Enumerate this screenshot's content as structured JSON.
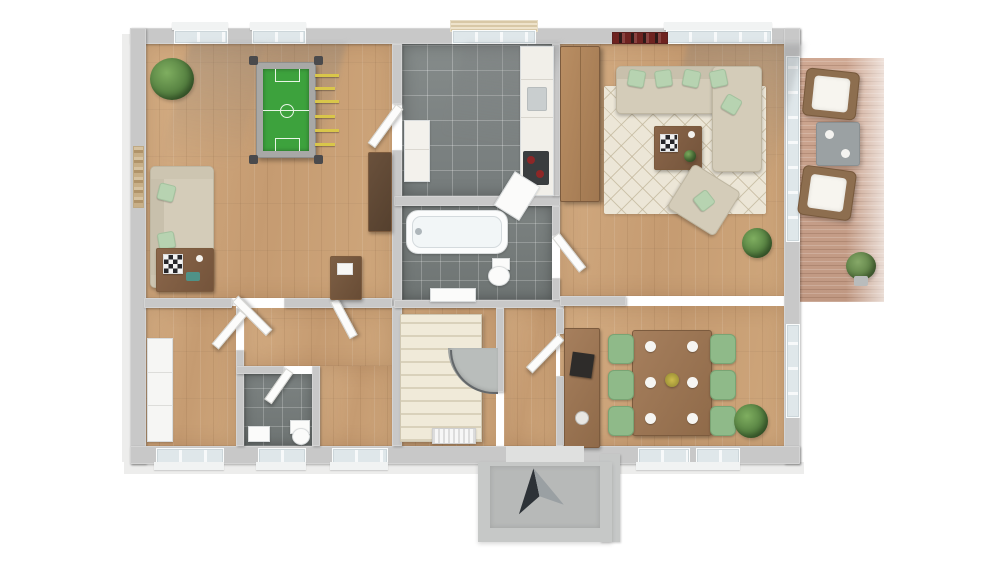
{
  "scene": {
    "type": "3d-floor-plan-render",
    "view": "top-down perspective of a single storey",
    "background": "#ffffff"
  },
  "palette": {
    "wall_cut": "#c8c8c8",
    "wall_face": "#f4f4f4",
    "hardwood": "#cba67c",
    "grey_tile": "#808686",
    "deck_wood": "#c8a18c",
    "rug": "#ece6d7",
    "sofa_beige": "#d4ccb9",
    "pillow_mint": "#b7d3b1",
    "chair_sage": "#8fba89",
    "furniture_wood": "#9c7758",
    "foosball_green": "#3da23d",
    "rod_yellow": "#d9c64a",
    "stairs_cream": "#efe9d8",
    "arrow_dark": "#2d3237",
    "arrow_grey": "#9aa0a3",
    "glass": "#e3ecef",
    "porch_concrete": "#c2c4c3"
  },
  "markers": {
    "entrance_arrow": "entry-direction-marker at south porch"
  },
  "rooms": [
    {
      "name": "games-room",
      "floor": "hardwood",
      "furniture": [
        "foosball-table",
        "sofa-with-mint-pillows",
        "coffee-table-with-chessboard",
        "corner-plant",
        "dark-sideboard",
        "desk",
        "wall-art"
      ]
    },
    {
      "name": "kitchen",
      "floor": "grey-tile",
      "furniture": [
        "counter-with-fridge",
        "sink",
        "cooktop-with-red-burners",
        "base-cabinet",
        "window-blinds",
        "open-appliance-door"
      ]
    },
    {
      "name": "bathroom",
      "floor": "grey-tile",
      "furniture": [
        "bathtub",
        "toilet",
        "washbasin"
      ]
    },
    {
      "name": "living-room",
      "floor": "hardwood",
      "furniture": [
        "corner-sofa-with-mint-pillows",
        "coffee-table-with-chessboard",
        "armchair",
        "diamond-pattern-rug",
        "tall-wood-cabinet",
        "potted-plant",
        "wall-art"
      ]
    },
    {
      "name": "dining-room",
      "floor": "hardwood",
      "furniture": [
        "wood-dining-table",
        "six-sage-green-chairs",
        "six-place-settings",
        "centerpiece",
        "sideboard-with-tv",
        "potted-plant"
      ]
    },
    {
      "name": "hallway",
      "floor": "hardwood",
      "furniture": [
        "winder-staircase",
        "radiator",
        "open-doors"
      ]
    },
    {
      "name": "bedroom",
      "floor": "hardwood",
      "furniture": [
        "white-wardrobe"
      ]
    },
    {
      "name": "wc",
      "floor": "grey-tile",
      "furniture": [
        "toilet",
        "small-washbasin"
      ]
    },
    {
      "name": "terrace",
      "floor": "wood-decking",
      "furniture": [
        "rattan-armchair-north",
        "grey-side-table",
        "rattan-armchair-south",
        "potted-plant"
      ]
    }
  ]
}
